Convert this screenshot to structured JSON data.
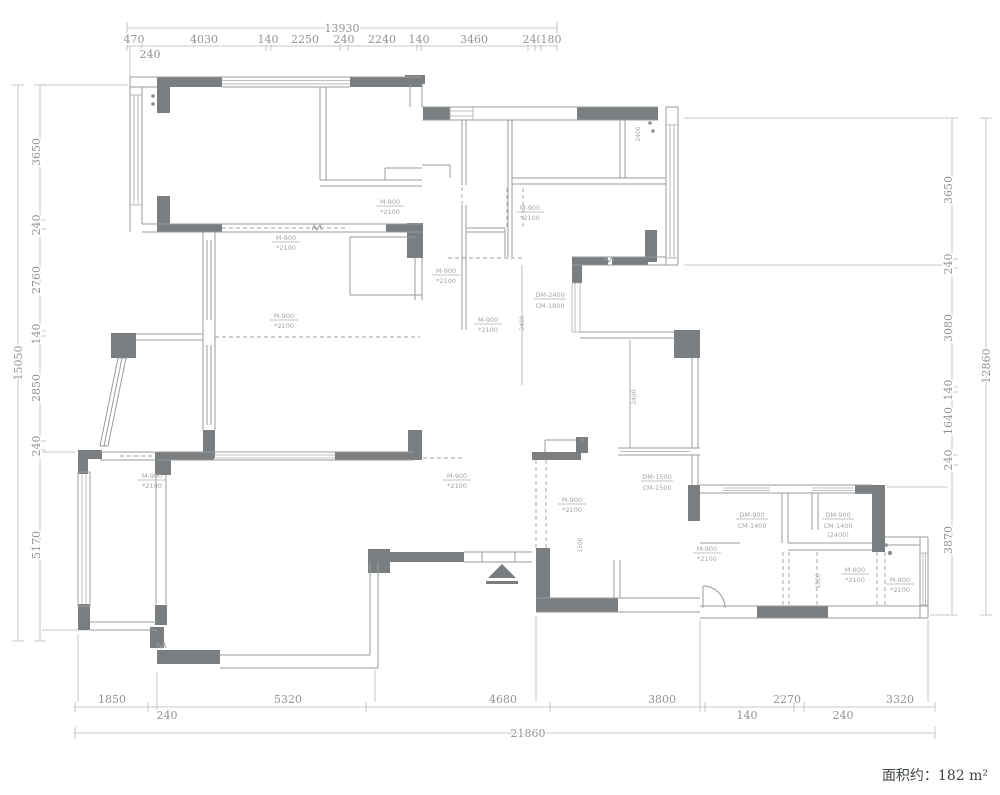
{
  "area_note": "面积约：182 m²",
  "colors": {
    "wall_fill": "#7a7e80",
    "wall_line": "#989c9e",
    "dim_line": "#b5b8ba",
    "dim_text": "#8f9496",
    "annotation_text": "#a2a6a8",
    "area_text": "#3f4446",
    "background": "#ffffff"
  },
  "dims": {
    "top": {
      "total": "13930",
      "segs": [
        "470",
        "4030",
        "140",
        "2250",
        "240",
        "2240",
        "140",
        "3460",
        "240",
        "180"
      ],
      "sub": [
        "240"
      ]
    },
    "left": {
      "total": "15050",
      "segs": [
        "3650",
        "240",
        "2760",
        "140",
        "2850",
        "240",
        "5170"
      ]
    },
    "right": {
      "total": "12860",
      "segs": [
        "3650",
        "240",
        "3080",
        "140",
        "1640",
        "240",
        "3870"
      ]
    },
    "bottom": {
      "total": "21860",
      "segs": [
        "1850",
        "5320",
        "4680",
        "3800",
        "2270",
        "3320"
      ],
      "sub": [
        "240",
        "140",
        "240"
      ]
    }
  },
  "doors": [
    {
      "w": "M-900",
      "h": "*2100"
    },
    {
      "w": "M-900",
      "h": "*2100"
    },
    {
      "w": "M-900",
      "h": "*2100"
    },
    {
      "w": "M-900",
      "h": "*2100"
    },
    {
      "w": "M-900",
      "h": "*2100"
    },
    {
      "w": "M-900",
      "h": "*2100"
    },
    {
      "w": "M-900",
      "h": "*2100"
    },
    {
      "w": "M-900",
      "h": "*2100"
    },
    {
      "w": "M-900",
      "h": "*2100"
    },
    {
      "w": "M-900",
      "h": "*2100"
    },
    {
      "w": "M-800",
      "h": "*2100"
    },
    {
      "w": "M-800",
      "h": "*2100"
    }
  ],
  "windows": [
    {
      "l1": "DM-2400",
      "l2": "CM-1800"
    },
    {
      "l1": "DM-1500",
      "l2": "CM-1500"
    },
    {
      "l1": "DM-900",
      "l2": "CM-1400"
    },
    {
      "l1": "DM-900",
      "l2": "CM-1400",
      "l3": "(2400)"
    }
  ],
  "rotated": [
    "2400",
    "2400",
    "2400",
    "1500",
    "1500"
  ]
}
